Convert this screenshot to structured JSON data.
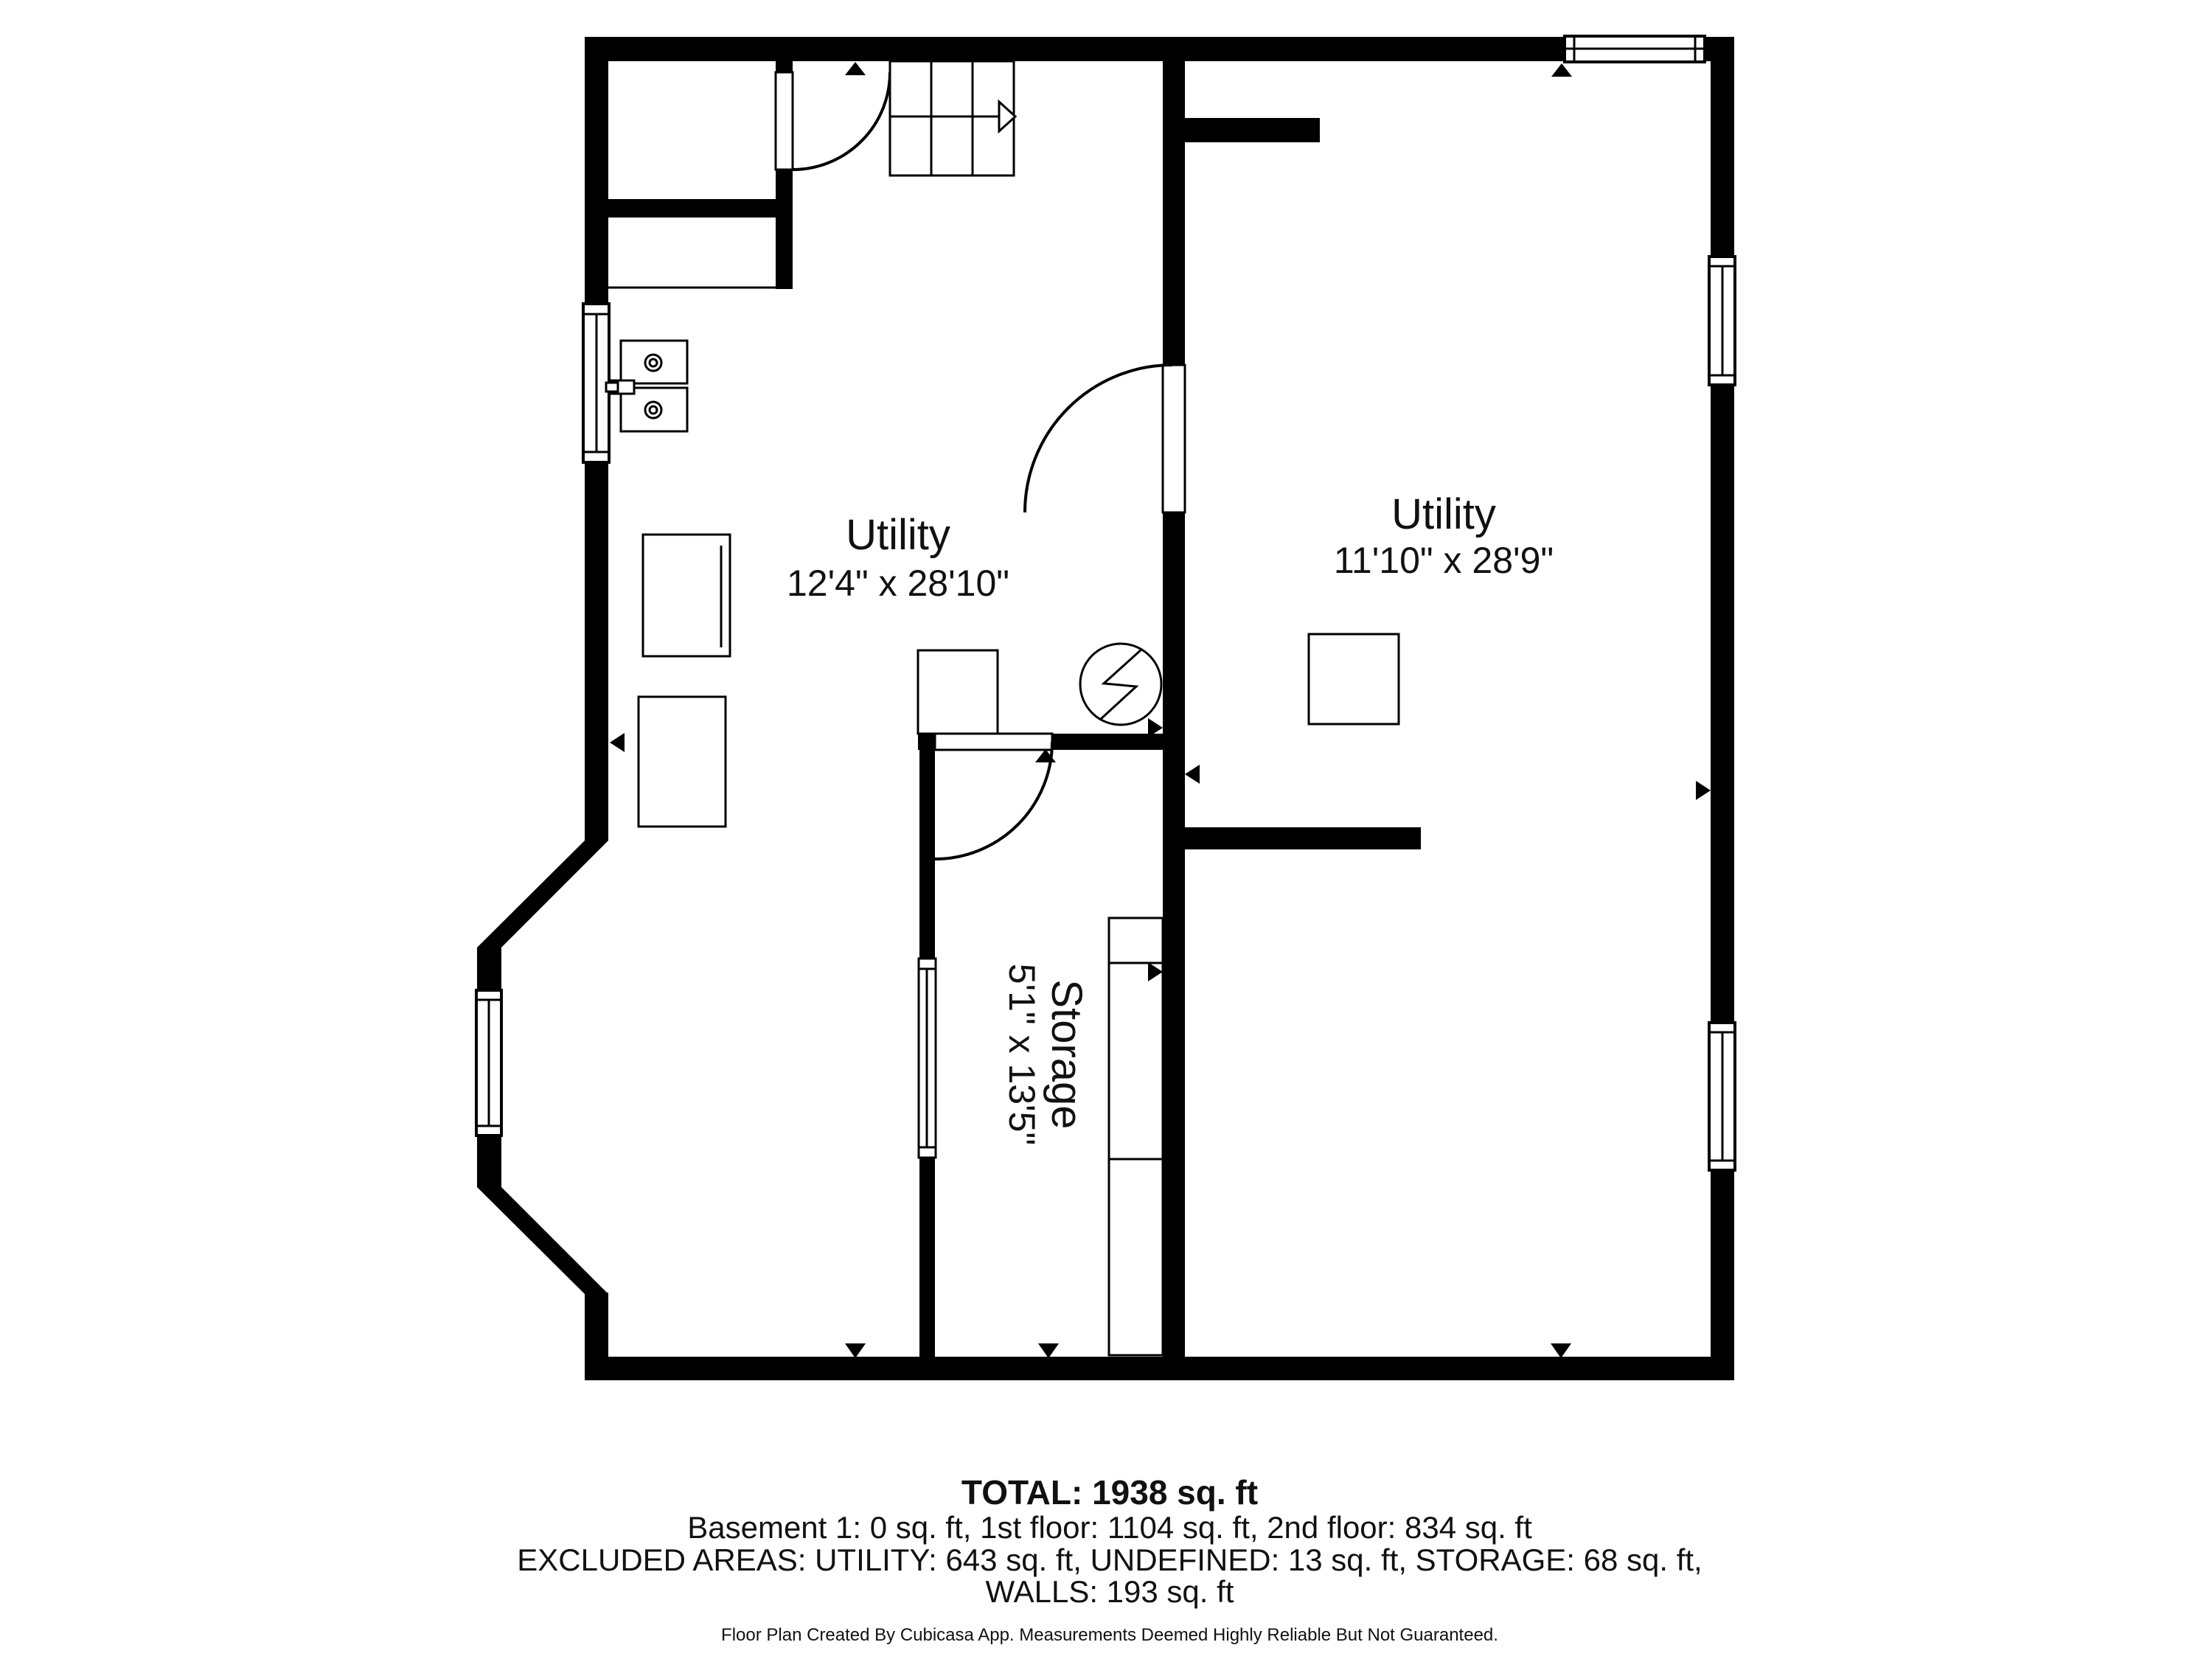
{
  "rooms": {
    "utility_left": {
      "name": "Utility",
      "dims": "12'4\" x 28'10\""
    },
    "utility_right": {
      "name": "Utility",
      "dims": "11'10\" x 28'9\""
    },
    "storage": {
      "name": "Storage",
      "dims": "5'1\" x 13'5\""
    }
  },
  "title_block": {
    "total": "TOTAL: 1938 sq. ft",
    "floors": "Basement 1: 0 sq. ft, 1st floor: 1104 sq. ft, 2nd floor: 834 sq. ft",
    "excluded": "EXCLUDED AREAS: UTILITY: 643 sq. ft, UNDEFINED: 13 sq. ft, STORAGE: 68 sq. ft,",
    "walls": "WALLS: 193 sq. ft",
    "disclaimer": "Floor Plan Created By Cubicasa App. Measurements Deemed Highly Reliable But Not Guaranteed."
  },
  "colors": {
    "wall": "#000000",
    "floor": "#ffffff"
  }
}
